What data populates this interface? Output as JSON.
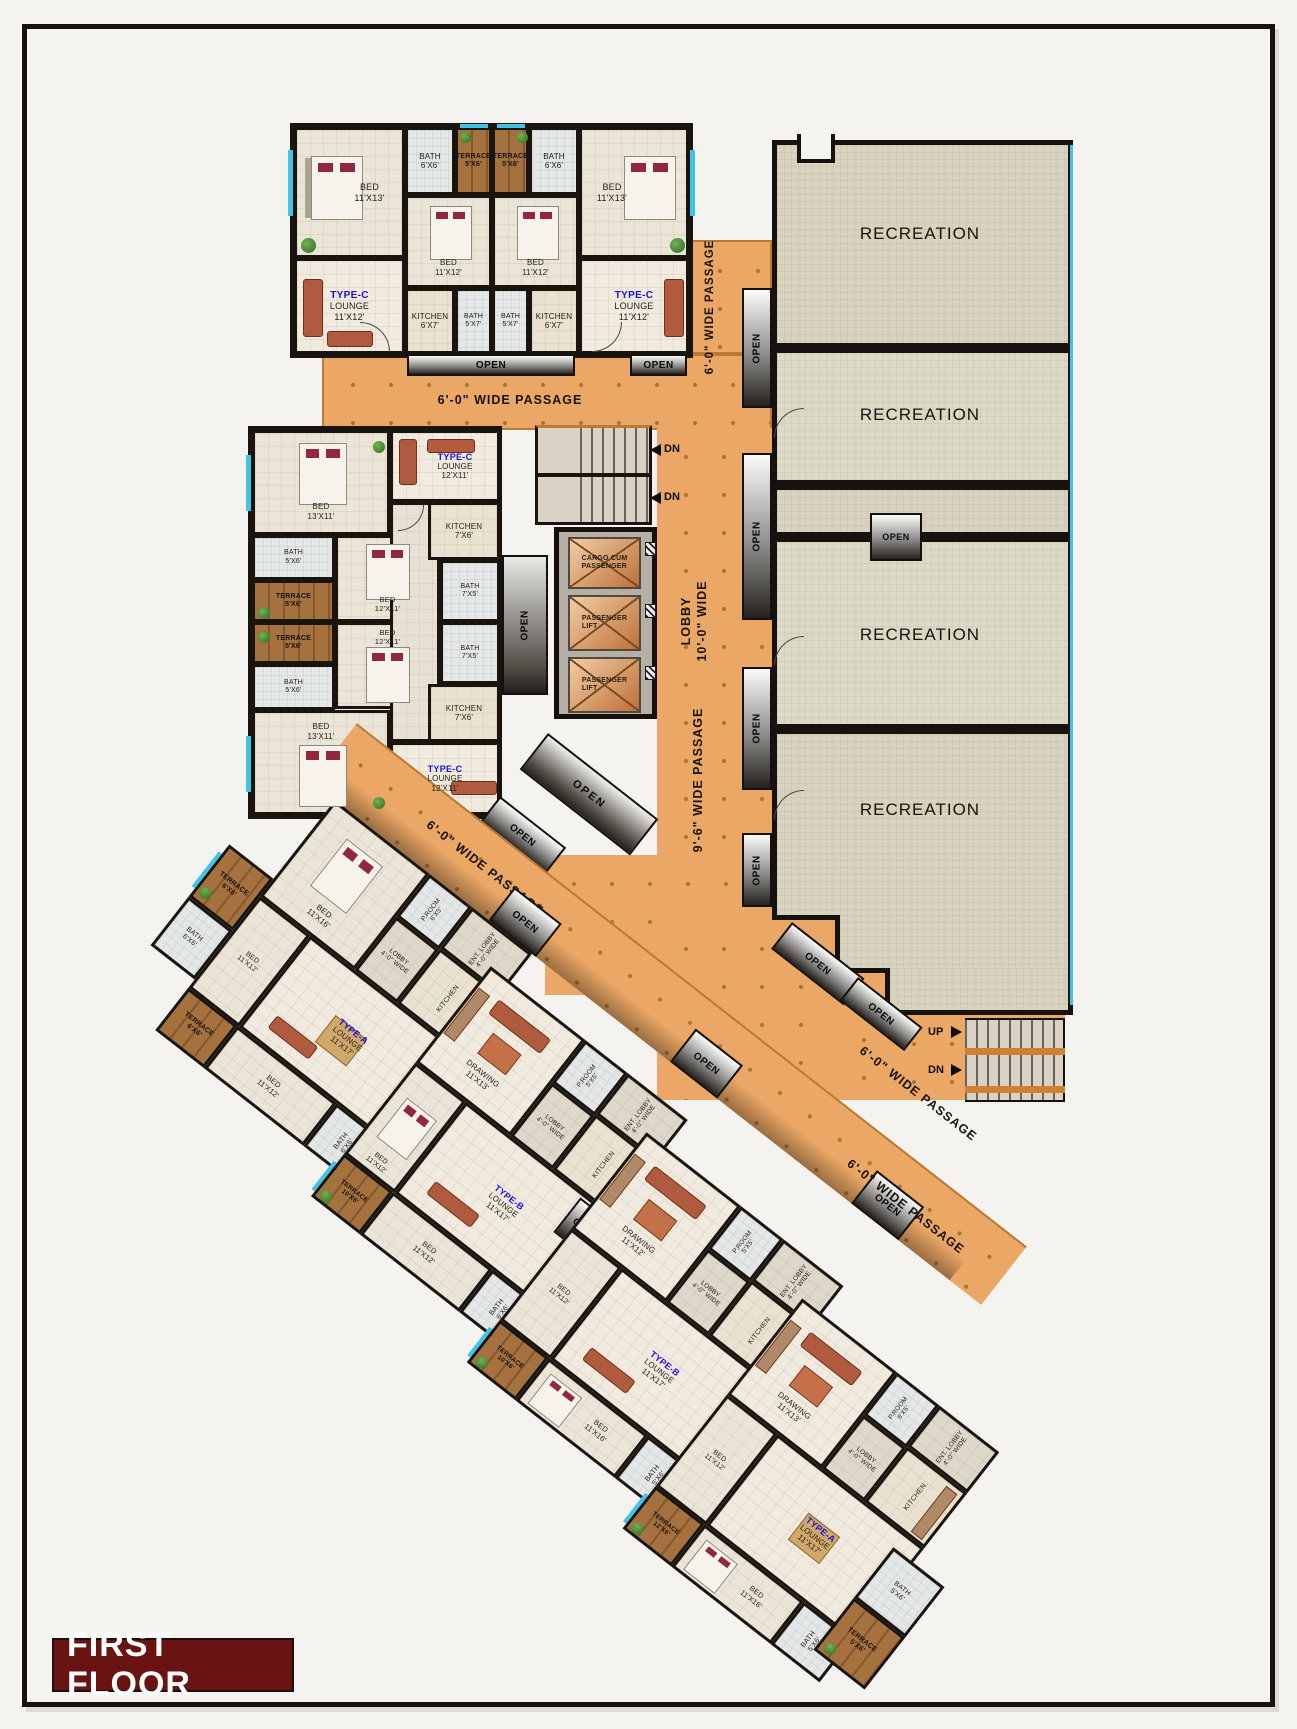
{
  "title": "FIRST FLOOR",
  "palette": {
    "passage_orange": "#eaa766",
    "wall": "#1a140f",
    "terrace_wood": "#a4713f",
    "window_cyan": "#3fc3e8",
    "type_label_blue": "#1b12d6",
    "recreation_fill": "#d8d3bf",
    "title_bg": "#6a1313"
  },
  "common": {
    "open": "OPEN",
    "recreation": "RECREATION",
    "up": "UP",
    "dn": "DN",
    "kitchen": "KITCHEN",
    "passage_6_0": "6'-0\" WIDE PASSAGE",
    "passage_9_6": "9'-6\" WIDE PASSAGE",
    "lobby_10_0": "LOBBY\n10'-0\" WIDE",
    "lobby_4_0": "LOBBY\n4'-0\" WIDE",
    "ent_lobby_4_0": "ENT. LOBBY\n4'-0\" WIDE"
  },
  "lifts": {
    "cargo": "CARGO CUM\nPASSENGER",
    "passenger": "PASSENGER\nLIFT"
  },
  "unit_types": {
    "a": "TYPE-A",
    "b": "TYPE-B",
    "c": "TYPE-C"
  },
  "rooms": {
    "lounge_11x12": "LOUNGE\n11'X12'",
    "lounge_12x11": "LOUNGE\n12'X11'",
    "lounge_11x17": "LOUNGE\n11'X17'",
    "bed_11x13": "BED\n11'X13'",
    "bed_11x12": "BED\n11'X12'",
    "bed_12x11": "BED\n12'X11'",
    "bed_13x11": "BED\n13'X11'",
    "bed_11x16": "BED\n11'X16'",
    "bath_6x6": "BATH\n6'X6'",
    "bath_5x7": "BATH\n5'X7'",
    "bath_5x6": "BATH\n5'X6'",
    "bath_7x5": "BATH\n7'X5'",
    "terrace_5x6": "TERRACE\n5'X6'",
    "terrace_6x6": "TERRACE\n6'X6'",
    "terrace_10x6": "TERRACE\n10'X6'",
    "terrace_12x6": "TERRACE\n12'X6'",
    "kitchen_6x7": "KITCHEN\n6'X7'",
    "kitchen_7x6": "KITCHEN\n7'X6'",
    "drawing_11x13": "DRAWING\n11'X13'",
    "drawing_11x12": "DRAWING\n11'X12'",
    "proom_6x5": "P.ROOM\n6'X5'",
    "proom_5x5": "P.ROOM\n5'X5'"
  }
}
